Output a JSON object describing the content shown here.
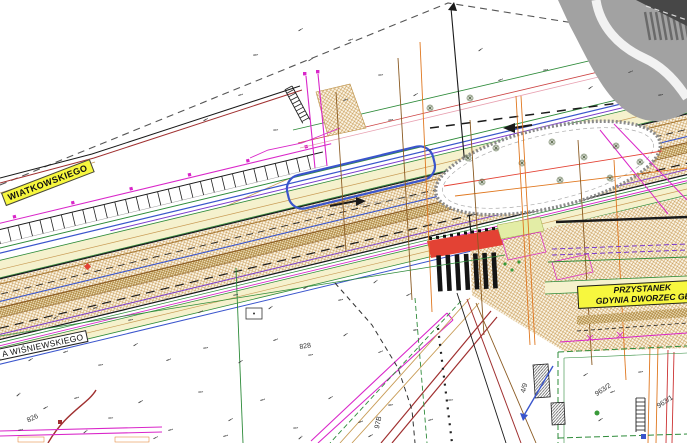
{
  "labels": {
    "street_upper": "WIATKOWSKIEGO",
    "street_lower": "A WIŚNIEWSKIEGO",
    "stop_line1": "PRZYSTANEK",
    "stop_line2": "GDYNIA DWORZEC GŁ",
    "parcel_828": "828",
    "parcel_826": "826",
    "parcel_963_2": "963/2",
    "parcel_963_1": "963/1",
    "parcel_4_9": "4/9",
    "parcel_97b": "97B"
  },
  "colors": {
    "label_yellow": "#f7f73e",
    "crossing_red": "#e34234",
    "road_hatch_tan": "#c89b55",
    "structure_gray": "#a2a2a2",
    "line_magenta": "#d926c9",
    "line_green": "#2e8b3a",
    "line_blue": "#3a55cc",
    "line_purple": "#7a3acc",
    "line_orange": "#e07820",
    "line_darkred": "#a03030"
  }
}
